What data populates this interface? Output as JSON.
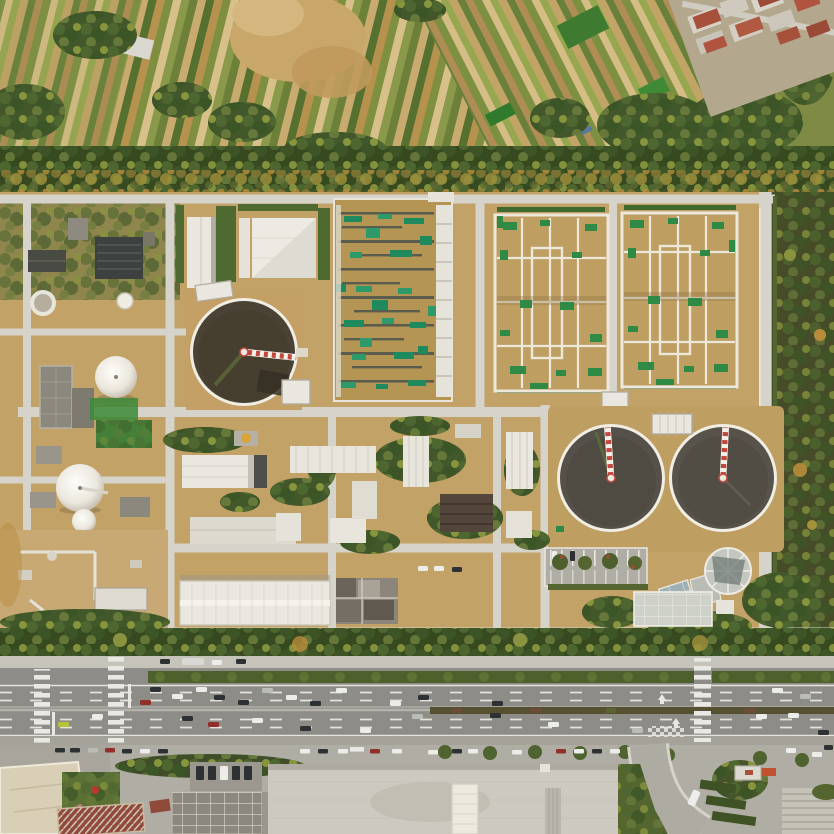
{
  "scene": {
    "type": "aerial-drone-photograph",
    "subject": "Aerial top-down view of a wastewater treatment plant campus bounded by farmland above and a multi-lane arterial road below",
    "lighting": "warm low-angle daylight",
    "regions": [
      {
        "name": "farmland-belt",
        "desc": "strip-cropped vegetable fields, bare dirt mound, red-roof village at top right"
      },
      {
        "name": "shelterbelt-tree-line",
        "desc": "dense tree row separating the fields from the plant"
      },
      {
        "name": "plant-campus",
        "desc": "clarifiers, aeration basin block, two covered bio-tank squares, dome gas holders, workshops and roads"
      },
      {
        "name": "arterial-road",
        "desc": "six-lane boulevard with planted medians, zebra crossings, moving traffic"
      },
      {
        "name": "street-frontage",
        "desc": "kerb parking, plaza, skylight roofs and an access road along the bottom"
      }
    ],
    "counts": {
      "circular_clarifiers": 3,
      "dome_gas_holders": 3,
      "covered_bio_tank_squares": 2,
      "aeration_basin_blocks": 1,
      "zebra_crossings": 3
    }
  },
  "palette": {
    "farmland_green": "#7f8a45",
    "farmland_tan": "#c9ab6f",
    "treeline_base": "#36491f",
    "woodland": "#474c28",
    "ground_tan": "#c2a267",
    "facility_road": "#d6d3ca",
    "hedge_green": "#4e6a31",
    "patch_green": "#2f8a46",
    "basin_tan": "#b59553",
    "square_basin_tan": "#bf9e61",
    "teal_green": "#1f8a5e",
    "water_dark": "#4a4234",
    "water_gray": "#55514a",
    "tank_rim": "#f0ede3",
    "arm_red": "#c2473c",
    "building_white": "#e9e7df",
    "dark_roof": "#3d4140",
    "brown_roof": "#53453a",
    "red_roof": "#a7503c",
    "asphalt": "#8e8c86",
    "sidewalk": "#c6c3ba",
    "plaza": "#cdc9c0",
    "lane_white": "#e4e3de",
    "car_white": "#ececeb",
    "car_dark": "#2e3134",
    "car_red": "#922f2b",
    "car_silver": "#babcb8",
    "car_yellow": "#b5c437"
  }
}
